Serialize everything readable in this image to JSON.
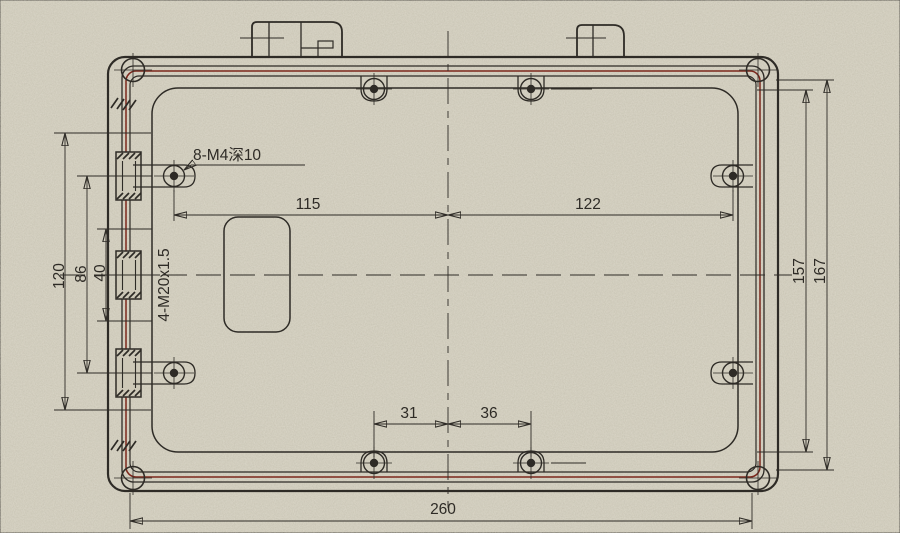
{
  "drawing": {
    "kind": "enclosure-rear-view-technical-drawing",
    "notes": {
      "screws": "8-M4深10",
      "glands": "4-M20x1.5"
    },
    "dims": {
      "d115": "115",
      "d122": "122",
      "d31": "31",
      "d36": "36",
      "d260": "260",
      "d120": "120",
      "d86": "86",
      "d40": "40",
      "d157": "157",
      "d167": "167"
    },
    "colors": {
      "paper": "#cdc8b7",
      "ink": "#2e2b26",
      "accent_red": "#7c281c"
    }
  }
}
